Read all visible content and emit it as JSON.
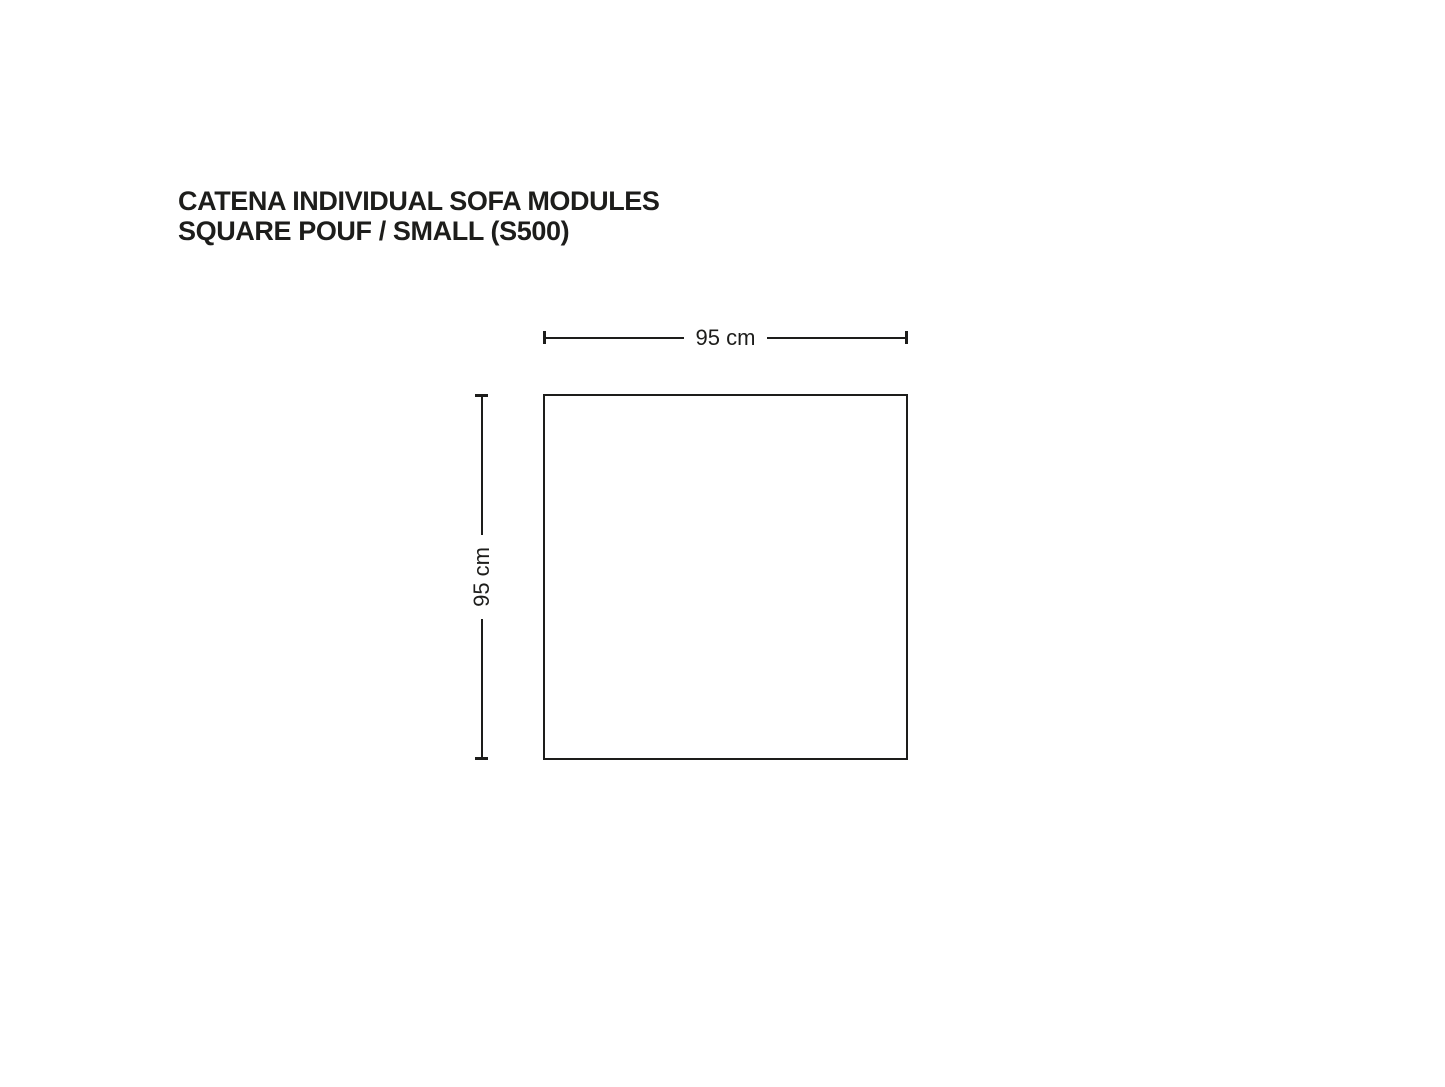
{
  "page": {
    "background": "#ffffff"
  },
  "title": {
    "line1": "CATENA INDIVIDUAL SOFA MODULES",
    "line2": "SQUARE POUF / SMALL (S500)"
  },
  "diagram": {
    "shape": "square",
    "width_label": "95 cm",
    "height_label": "95 cm"
  },
  "colors": {
    "ink": "#1d1d1b",
    "background": "#ffffff"
  }
}
